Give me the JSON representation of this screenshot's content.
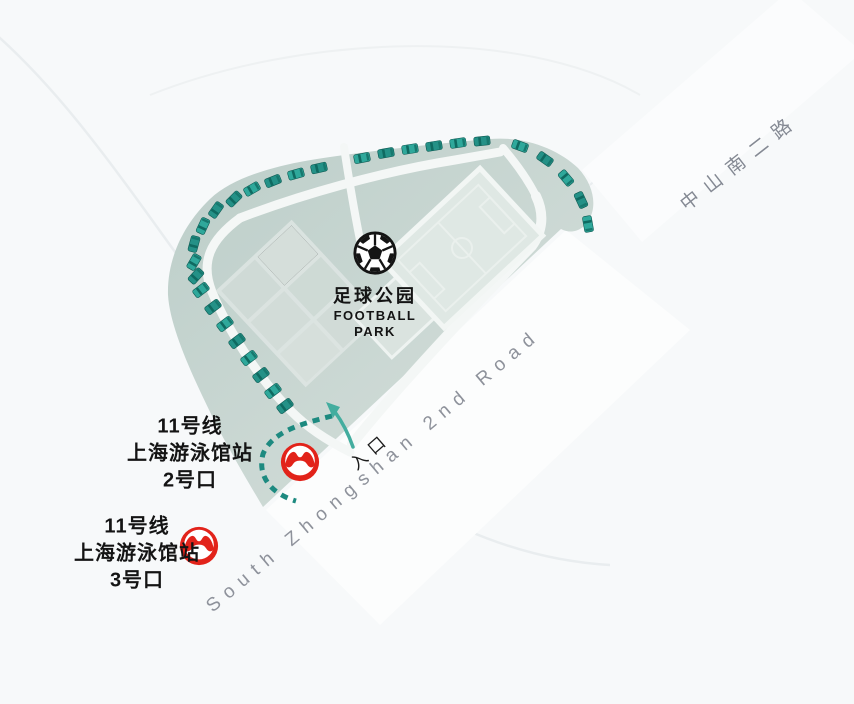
{
  "park": {
    "title_zh": "足球公园",
    "title_en_line1": "FOOTBALL",
    "title_en_line2": "PARK"
  },
  "entrance": {
    "label": "入口"
  },
  "roads": [
    {
      "id": "south-zhongshan-2nd-road",
      "label": "South Zhongshan 2nd Road"
    },
    {
      "id": "zhongshan-south-2nd-road",
      "label": "中山南二路"
    }
  ],
  "metro_exits": [
    {
      "line": "11号线",
      "station": "上海游泳馆站",
      "exit": "2号口"
    },
    {
      "line": "11号线",
      "station": "上海游泳馆站",
      "exit": "3号口"
    }
  ],
  "icons": {
    "football": "football-icon",
    "metro": "shanghai-metro-logo",
    "entrance_arrow": "entrance-arrow-icon"
  },
  "colors": {
    "park_fill_dark": "#bccec9",
    "park_fill_light": "#d7e0dc",
    "car_teal": "#2aa094",
    "metro_red": "#e2231a",
    "road_text_gray": "#8e929b",
    "label_black": "#141414",
    "arrow_teal": "#43ad9f"
  }
}
